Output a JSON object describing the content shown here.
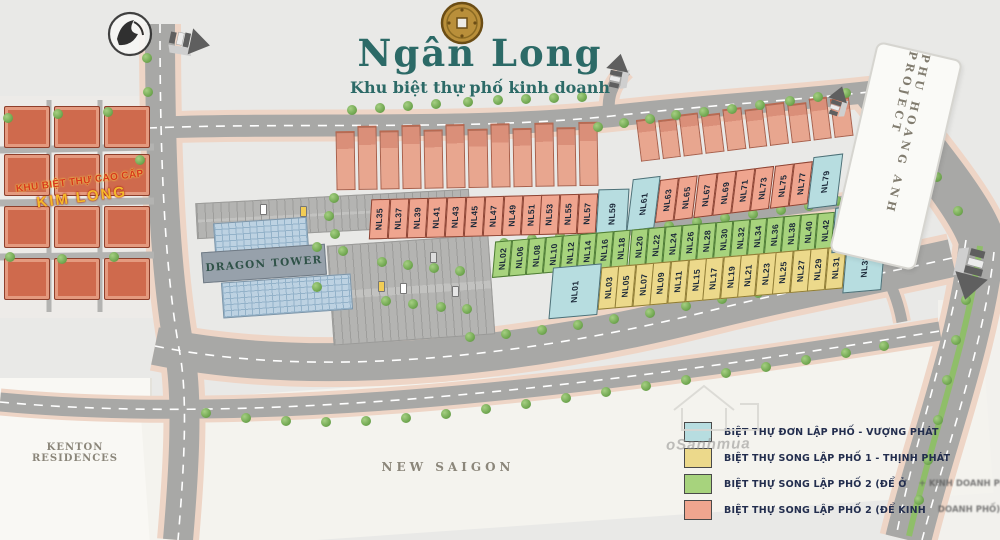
{
  "header": {
    "title": "Ngân Long",
    "subtitle": "Khu biệt thự phố kinh doanh",
    "coin_icon": "ancient-coin"
  },
  "areas": {
    "kim_long_line1": "KHU BIỆT THỰ CAO CẤP",
    "kim_long_line2": "KIM LONG",
    "dragon_tower": "DRAGON TOWER",
    "kenton": "KENTON RESIDENCES",
    "new_saigon": "NEW SAIGON",
    "phu_hoang_anh": "PHU HOANG ANH PROJECT"
  },
  "colors": {
    "b": "#b7dde0",
    "s": "#efa58f",
    "g": "#a7d37d",
    "y": "#ecd98b"
  },
  "legend": {
    "items": [
      {
        "color": "#b7dde0",
        "label": "BIỆT THỰ ĐƠN LẬP PHỐ - VƯỢNG PHÁT",
        "obscured_tail": ""
      },
      {
        "color": "#ecd98b",
        "label": "BIỆT THỰ SONG LẬP PHỐ 1 - THỊNH PHÁT",
        "obscured_tail": ""
      },
      {
        "color": "#a7d37d",
        "label": "BIỆT THỰ SONG LẬP PHỐ 2 (ĐỂ Ở",
        "obscured_tail": " + KINH DOANH PHỐ)"
      },
      {
        "color": "#efa58f",
        "label": "BIỆT THỰ SONG LẬP PHỐ 2 (ĐỂ KINH",
        "obscured_tail": " DOANH PHỐ)"
      }
    ]
  },
  "plan": {
    "rows": [
      {
        "id": "row-top",
        "lots": [
          {
            "label": "NL35",
            "type": "s"
          },
          {
            "label": "NL37",
            "type": "s"
          },
          {
            "label": "NL39",
            "type": "s"
          },
          {
            "label": "NL41",
            "type": "s"
          },
          {
            "label": "NL43",
            "type": "s"
          },
          {
            "label": "NL45",
            "type": "s"
          },
          {
            "label": "NL47",
            "type": "s"
          },
          {
            "label": "NL49",
            "type": "s"
          },
          {
            "label": "NL51",
            "type": "s"
          },
          {
            "label": "NL53",
            "type": "s"
          },
          {
            "label": "NL55",
            "type": "s"
          },
          {
            "label": "NL57",
            "type": "s"
          },
          {
            "label": "NL59",
            "type": "b",
            "w": 1.7,
            "big": true
          }
        ]
      },
      {
        "id": "row-right",
        "lots": [
          {
            "label": "NL61",
            "type": "b",
            "w": 1.5,
            "big": true
          },
          {
            "label": "NL63",
            "type": "s"
          },
          {
            "label": "NL65",
            "type": "s"
          },
          {
            "label": "NL67",
            "type": "s"
          },
          {
            "label": "NL69",
            "type": "s"
          },
          {
            "label": "NL71",
            "type": "s"
          },
          {
            "label": "NL73",
            "type": "s"
          },
          {
            "label": "NL75",
            "type": "s"
          },
          {
            "label": "NL77",
            "type": "s"
          },
          {
            "label": "NL79",
            "type": "b",
            "w": 1.6,
            "big": true
          }
        ]
      },
      {
        "id": "row-mid-green",
        "lots": [
          {
            "label": "NL02",
            "type": "g"
          },
          {
            "label": "NL06",
            "type": "g"
          },
          {
            "label": "NL08",
            "type": "g"
          },
          {
            "label": "NL10",
            "type": "g"
          },
          {
            "label": "NL12",
            "type": "g"
          },
          {
            "label": "NL14",
            "type": "g"
          },
          {
            "label": "NL16",
            "type": "g"
          },
          {
            "label": "NL18",
            "type": "g"
          },
          {
            "label": "NL20",
            "type": "g"
          },
          {
            "label": "NL22",
            "type": "g"
          },
          {
            "label": "NL24",
            "type": "g"
          },
          {
            "label": "NL26",
            "type": "g"
          },
          {
            "label": "NL28",
            "type": "g"
          },
          {
            "label": "NL30",
            "type": "g"
          },
          {
            "label": "NL32",
            "type": "g"
          },
          {
            "label": "NL34",
            "type": "g"
          },
          {
            "label": "NL36",
            "type": "g"
          },
          {
            "label": "NL38",
            "type": "g"
          },
          {
            "label": "NL40",
            "type": "g"
          },
          {
            "label": "NL42",
            "type": "g"
          },
          {
            "label": "NL46",
            "type": "b",
            "w": 2.3,
            "big": true
          }
        ]
      },
      {
        "id": "row-mid-yellow",
        "lots": [
          {
            "label": "NL01",
            "type": "b",
            "w": 3,
            "big": true
          },
          {
            "label": "NL03",
            "type": "y"
          },
          {
            "label": "NL05",
            "type": "y"
          },
          {
            "label": "NL07",
            "type": "y"
          },
          {
            "label": "NL09",
            "type": "y"
          },
          {
            "label": "NL11",
            "type": "y"
          },
          {
            "label": "NL15",
            "type": "y"
          },
          {
            "label": "NL17",
            "type": "y"
          },
          {
            "label": "NL19",
            "type": "y"
          },
          {
            "label": "NL21",
            "type": "y"
          },
          {
            "label": "NL23",
            "type": "y"
          },
          {
            "label": "NL25",
            "type": "y"
          },
          {
            "label": "NL27",
            "type": "y"
          },
          {
            "label": "NL29",
            "type": "y"
          },
          {
            "label": "NL31",
            "type": "y"
          },
          {
            "label": "NL33",
            "type": "b",
            "w": 2.4,
            "big": true
          }
        ]
      }
    ]
  },
  "watermark": {
    "text": "oSanhmua"
  }
}
